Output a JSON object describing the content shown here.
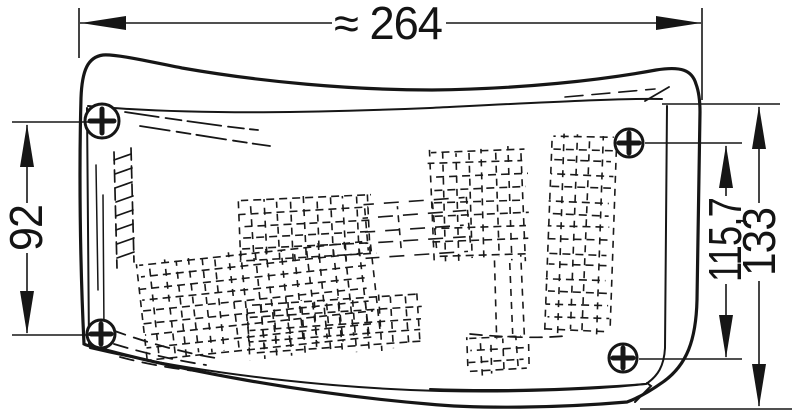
{
  "page": {
    "background": "#ffffff",
    "line_color": "#161616"
  },
  "drawing": {
    "kind": "technical line drawing of a wrap-around vehicle lamp, front view with mounting screws",
    "screw_count": 4
  },
  "dimensions": {
    "width_top": {
      "label": "≈ 264",
      "value": "264",
      "approx": true
    },
    "height_left": {
      "label": "92",
      "value": "92",
      "approx": false
    },
    "height_right_inner": {
      "label": "115,7",
      "value": "115,7",
      "approx": false
    },
    "height_right_outer": {
      "label": "133",
      "value": "133",
      "approx": false
    }
  }
}
